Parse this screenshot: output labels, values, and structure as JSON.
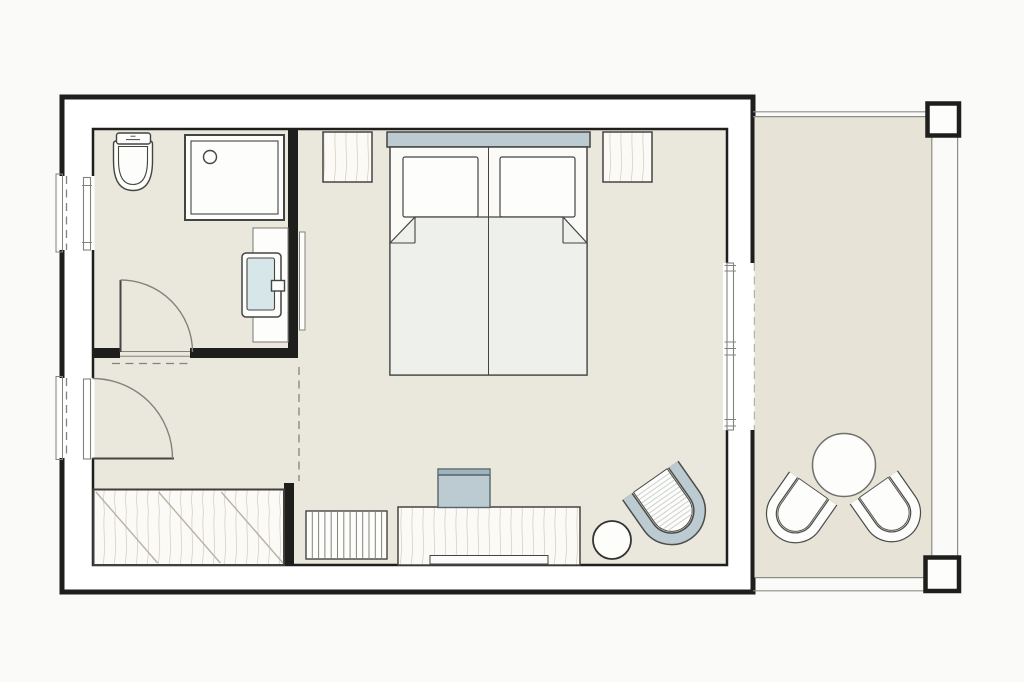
{
  "canvas": {
    "width": 1024,
    "height": 682
  },
  "colors": {
    "bg": "#fafaf8",
    "wall": "#1e1e1c",
    "floor": "#eae7dd",
    "bfloor": "#e7e4d7",
    "white": "#fdfdfb",
    "accent": "#bccbd1",
    "accentDark": "#5f7680",
    "sink": "#d7e7e9",
    "duvet": "#eef0ec",
    "furn": "#fbfaf6",
    "grain": "#ddd9cc",
    "lineDark": "#444442",
    "lineMid": "#83837e",
    "lineLight": "#b7b3a7",
    "rail": "#8d8d88"
  },
  "plan": {
    "type": "hotel-room-floor-plan",
    "rooms": [
      "bathroom",
      "entry-hall",
      "wardrobe-nook",
      "bedroom",
      "balcony"
    ],
    "furniture": [
      "toilet",
      "shower",
      "washbasin-vanity",
      "wall-panel",
      "wardrobe",
      "double-bed",
      "headboard",
      "pillow-left",
      "pillow-right",
      "nightstand-left",
      "nightstand-right",
      "desk",
      "desk-chair",
      "radiator",
      "stool",
      "lounge-chair",
      "balcony-table",
      "balcony-chair-left",
      "balcony-chair-right"
    ],
    "openings": [
      "entrance-door",
      "bathroom-door",
      "sliding-balcony-door",
      "window-recess",
      "balcony-railing",
      "balcony-posts"
    ]
  }
}
